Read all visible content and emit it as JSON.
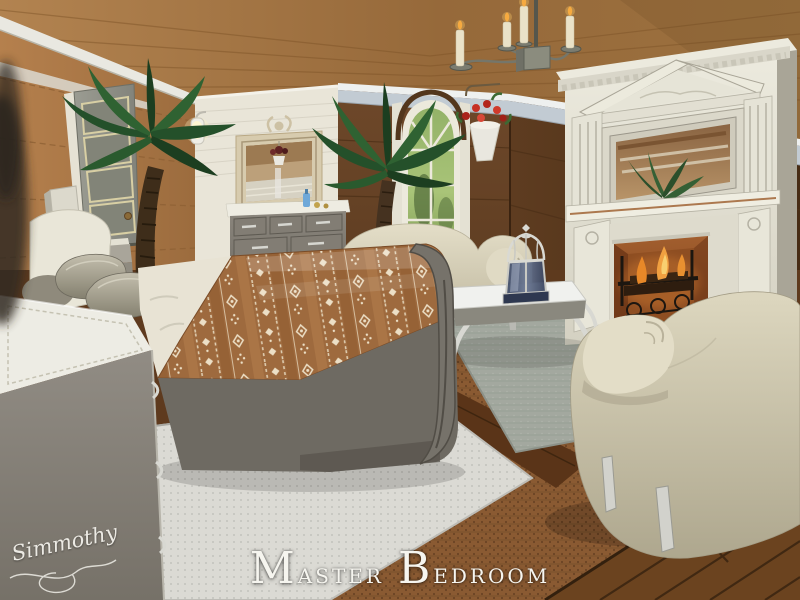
{
  "screenshot": {
    "kind": "game-interior-screenshot",
    "caption": {
      "full": "Master Bedroom",
      "words": [
        "Master",
        "Bedroom"
      ],
      "color": "#f6f5ef"
    },
    "signature": {
      "text": "Simmothy",
      "color": "#eceae4"
    }
  },
  "palette": {
    "ceiling_wood": "#a1743f",
    "left_wall_tan": "#b07c4a",
    "accent_wall_white": "#e9e5d8",
    "dark_wall_brown": "#5e3c20",
    "trim_band_blue": "#c2cbd3",
    "floor_plank": "#66401f",
    "woven_mat": "#8a5a32",
    "area_rug_gray": "#a3a89f",
    "area_rug_white": "#dbdad4",
    "bedding_brown": "#9e6a3e",
    "bedding_motif_cream": "#ecdfc6",
    "upholstery_cream": "#ddd7c0",
    "fireplace_white": "#e8e6dc",
    "firebox_copper": "#9c5a2c",
    "flame_orange": "#f0a040",
    "palm_green": "#2f6130",
    "furniture_gray": "#8b867d"
  },
  "scene_objects": [
    {
      "id": "wood-ceiling",
      "label": "Diagonal wood plank ceiling"
    },
    {
      "id": "left-wall",
      "label": "Tan paneled wall with crown trim"
    },
    {
      "id": "accent-wall",
      "label": "White horizontal siding accent wall"
    },
    {
      "id": "dark-walls",
      "label": "Dark brown paneled walls with blue-gray trim band"
    },
    {
      "id": "door",
      "label": "Gray four-panel door"
    },
    {
      "id": "wall-sconce",
      "label": "Lit white wall sconce"
    },
    {
      "id": "wall-mirror",
      "label": "Ornate framed wall mirror"
    },
    {
      "id": "dresser",
      "label": "Gray dresser with white top and bottles"
    },
    {
      "id": "arched-window",
      "label": "Arched white window with garden view"
    },
    {
      "id": "hanging-planter",
      "label": "Wall planter with red flowers"
    },
    {
      "id": "palm-tree-left",
      "label": "Indoor palm tree by door"
    },
    {
      "id": "palm-tree-center",
      "label": "Indoor palm tree by window"
    },
    {
      "id": "fireplace",
      "label": "Ornate white fireplace with pediment, mirror and burning fire"
    },
    {
      "id": "chandelier",
      "label": "Candle chandelier"
    },
    {
      "id": "sleigh-bed",
      "label": "Sleigh bed with brown tribal-pattern blanket and pillows"
    },
    {
      "id": "storage-chest",
      "label": "Gray storage chest with white cushioned top"
    },
    {
      "id": "loveseat",
      "label": "Cream camelback loveseat"
    },
    {
      "id": "armchair",
      "label": "Cream rolled-arm armchair"
    },
    {
      "id": "coffee-table",
      "label": "White coffee table with cabriole legs"
    },
    {
      "id": "candle-lantern",
      "label": "Blue glass candle lantern"
    },
    {
      "id": "gray-rug",
      "label": "Gray area rug"
    },
    {
      "id": "white-rug",
      "label": "Light dotted area rug"
    },
    {
      "id": "wood-floor",
      "label": "Dark plank floor with woven mat border"
    }
  ]
}
